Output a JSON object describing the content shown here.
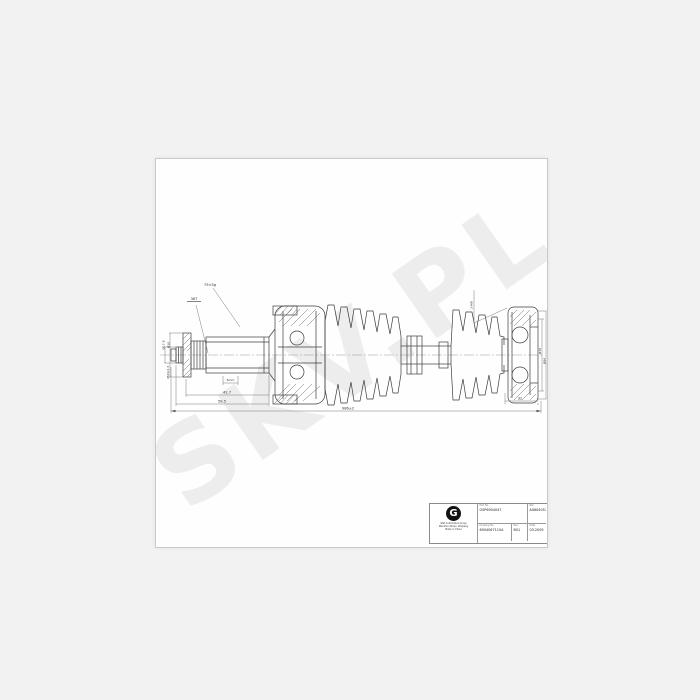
{
  "watermark": {
    "text": "SKV.PL"
  },
  "drawing": {
    "dims": {
      "weight": "75±5g",
      "spline": "36T",
      "gap": "5mm",
      "len_a": "42.7",
      "len_b": "58.5",
      "overall": "986±2",
      "right_len": "32",
      "dia_small": "Ø17.8",
      "dia_mid": "Ø30",
      "thread": "M24x1.5",
      "holes": "2-M8",
      "dia_r1": "Ø79",
      "dia_r2": "Ø84"
    }
  },
  "title_block": {
    "logo_letter": "G",
    "company_lines": [
      "GSP Automotive Group",
      "Wenzhou Ruian, Zhejiang",
      "Made in China"
    ],
    "cells": {
      "a_label": "Part No.",
      "a_value": "GSP6904047",
      "b_label": "Ref.",
      "b_value": "A0604057",
      "c_label": "Drawing No.",
      "c_value": "6904067110A",
      "d_label": "Rev.",
      "d_value": "B01",
      "e_label": "Date",
      "e_value": "03.2009"
    }
  }
}
